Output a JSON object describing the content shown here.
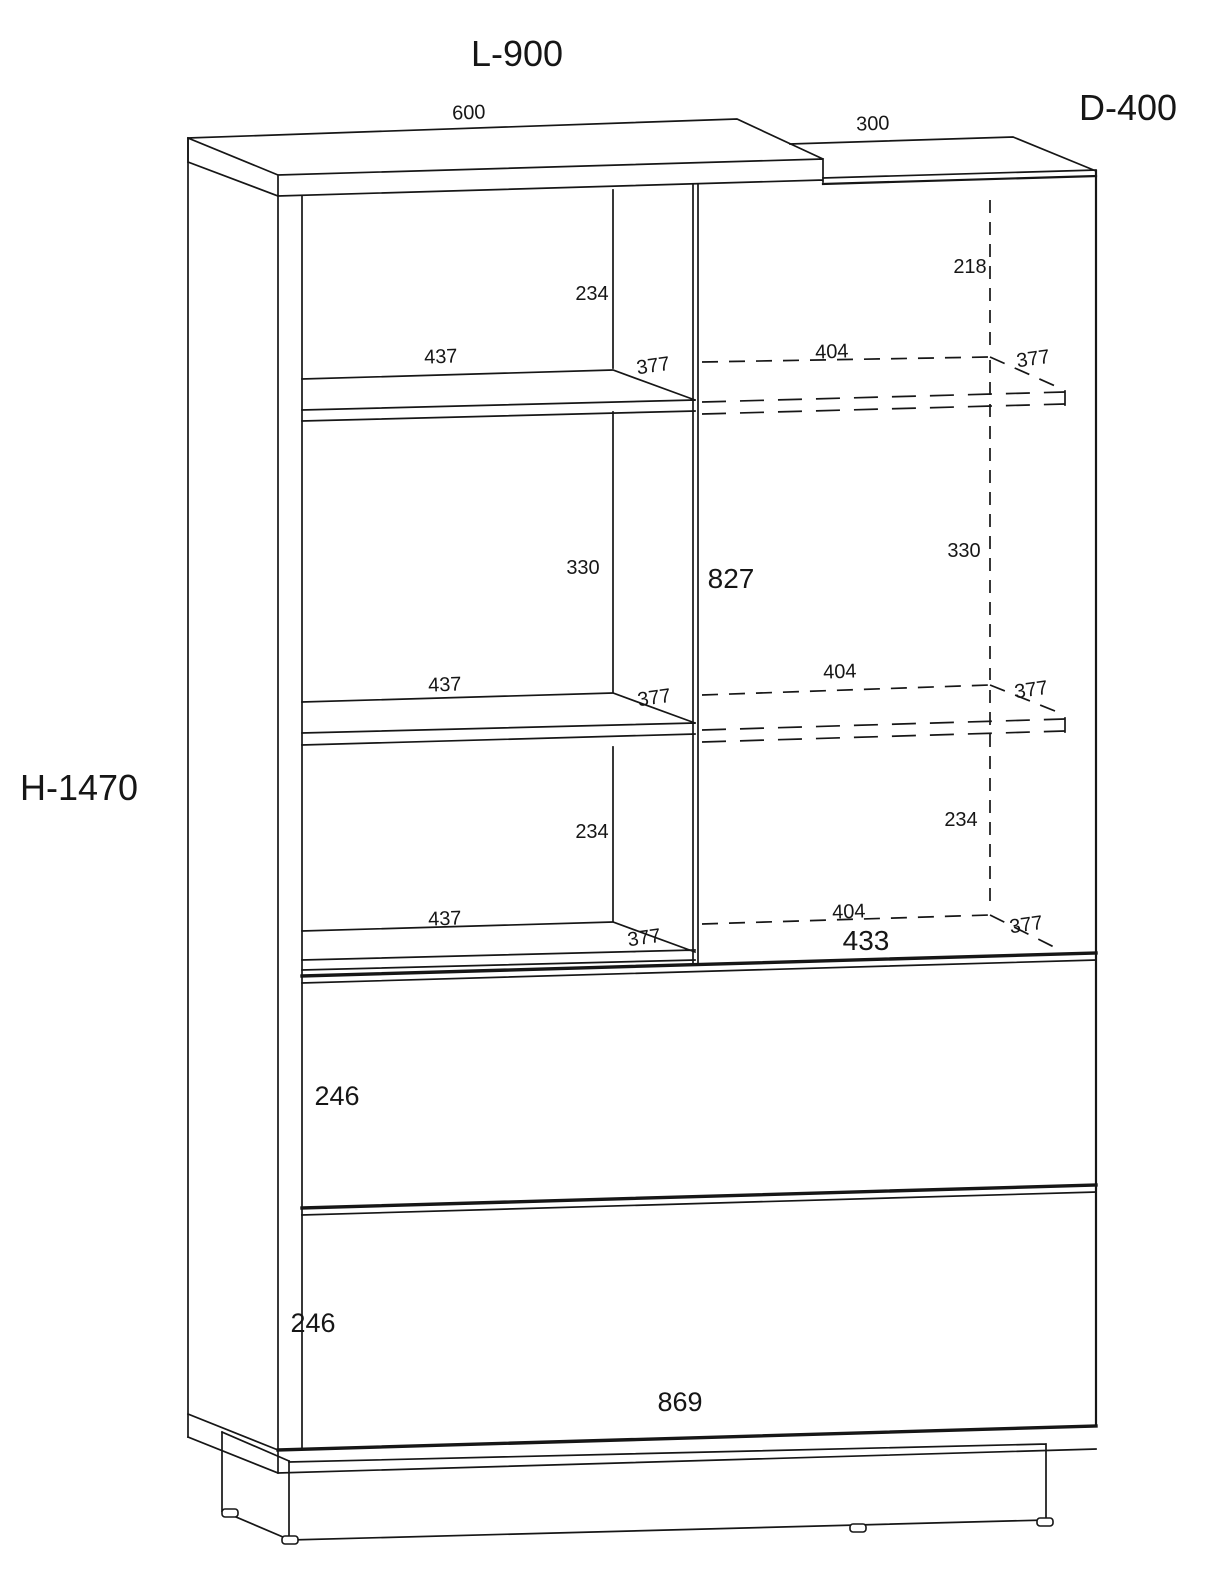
{
  "drawing": {
    "overall": {
      "length": "L-900",
      "depth": "D-400",
      "height": "H-1470"
    },
    "top": {
      "left_section_width": "600",
      "right_section_width": "300"
    },
    "left_column": {
      "gap_top": "234",
      "gap_middle": "330",
      "gap_bottom": "234",
      "shelf1": {
        "width": "437",
        "depth": "377"
      },
      "shelf2": {
        "width": "437",
        "depth": "377"
      },
      "shelf3": {
        "width": "437",
        "depth": "377"
      }
    },
    "right_column": {
      "door_opening_height": "827",
      "top_gap": "218",
      "gap_middle": "330",
      "gap_bottom": "234",
      "opening_width": "433",
      "shelf1": {
        "width": "404",
        "depth": "377"
      },
      "shelf2": {
        "width": "404",
        "depth": "377"
      },
      "shelf3": {
        "width": "404",
        "depth": "377"
      }
    },
    "drawers": {
      "upper_height": "246",
      "lower_height": "246",
      "inner_width": "869"
    }
  }
}
